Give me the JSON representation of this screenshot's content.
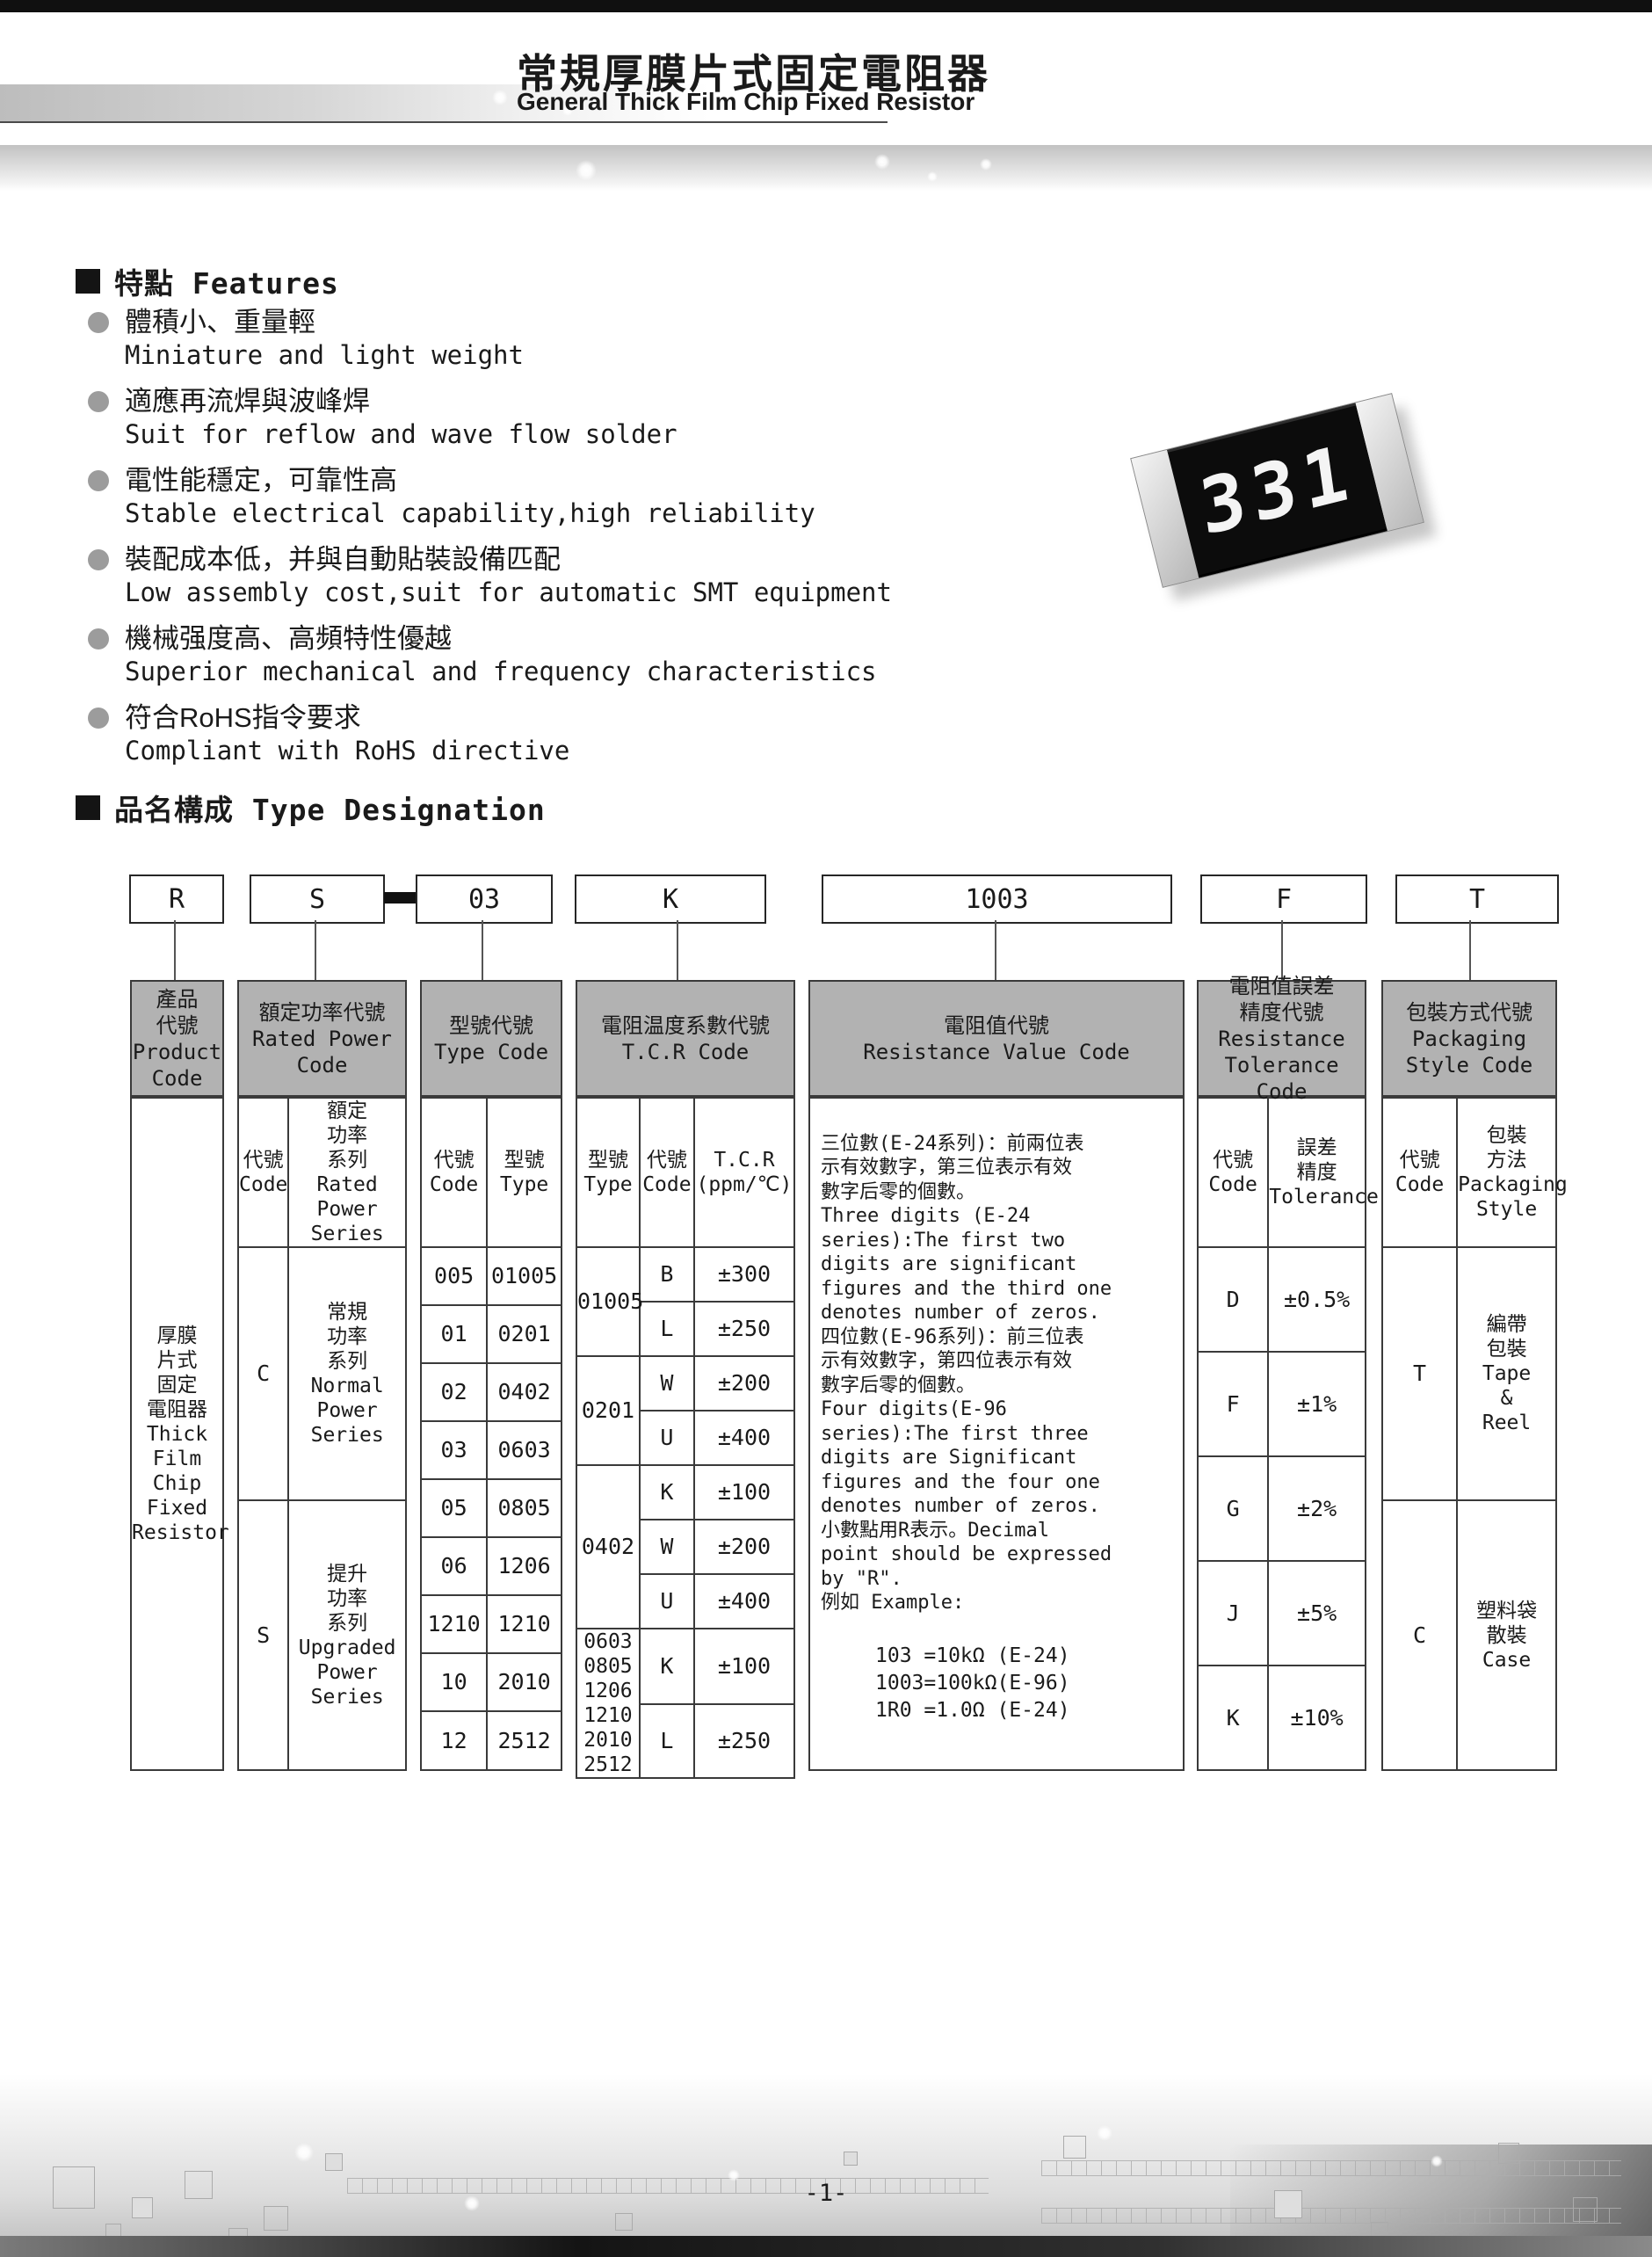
{
  "header": {
    "title_cn": "常規厚膜片式固定電阻器",
    "title_en": "General Thick Film Chip Fixed Resistor"
  },
  "features": {
    "heading": "特點 Features",
    "items": [
      {
        "cn": "體積小、重量輕",
        "en": "Miniature and light weight"
      },
      {
        "cn": "適應再流焊與波峰焊",
        "en": "Suit for reflow and wave flow solder"
      },
      {
        "cn": "電性能穩定，可靠性高",
        "en": "Stable electrical capability,high reliability"
      },
      {
        "cn": "裝配成本低，并與自動貼裝設備匹配",
        "en": "Low assembly cost,suit for automatic SMT equipment"
      },
      {
        "cn": "機械强度高、高頻特性優越",
        "en": "Superior mechanical and frequency characteristics"
      },
      {
        "cn": "符合RoHS指令要求",
        "en": "Compliant with RoHS directive"
      }
    ]
  },
  "chip": {
    "marking": "331"
  },
  "type_designation": {
    "heading": "品名構成  Type Designation",
    "boxes": [
      "R",
      "S",
      "03",
      "K",
      "1003",
      "F",
      "T"
    ],
    "separator_symbol": "-"
  },
  "table": {
    "product": {
      "header": [
        "產品",
        "代號",
        "Product",
        "Code"
      ],
      "body": [
        "厚膜",
        "片式",
        "固定",
        "電阻器",
        "Thick",
        "Film",
        "Chip",
        "Fixed",
        "Resistor"
      ]
    },
    "power": {
      "header": [
        "額定功率代號",
        "Rated Power",
        "Code"
      ],
      "sub_code": [
        "代號",
        "Code"
      ],
      "sub_series": [
        "額定",
        "功率",
        "系列",
        "Rated",
        "Power",
        "Series"
      ],
      "rows": [
        {
          "code": "C",
          "series": [
            "常規",
            "功率",
            "系列",
            "Normal",
            "Power",
            "Series"
          ]
        },
        {
          "code": "S",
          "series": [
            "提升",
            "功率",
            "系列",
            "Upgraded",
            "Power",
            "Series"
          ]
        }
      ]
    },
    "type": {
      "header": [
        "型號代號",
        "Type Code"
      ],
      "sub_code": [
        "代號",
        "Code"
      ],
      "sub_type": [
        "型號",
        "Type"
      ],
      "rows": [
        [
          "005",
          "01005"
        ],
        [
          "01",
          "0201"
        ],
        [
          "02",
          "0402"
        ],
        [
          "03",
          "0603"
        ],
        [
          "05",
          "0805"
        ],
        [
          "06",
          "1206"
        ],
        [
          "1210",
          "1210"
        ],
        [
          "10",
          "2010"
        ],
        [
          "12",
          "2512"
        ]
      ]
    },
    "tcr": {
      "header": [
        "電阻温度系數代號",
        "T.C.R Code"
      ],
      "sub_type": [
        "型號",
        "Type"
      ],
      "sub_code": [
        "代號",
        "Code"
      ],
      "sub_tcr": [
        "T.C.R",
        "(ppm/℃)"
      ],
      "groups": [
        {
          "type": "01005",
          "rows": [
            [
              "B",
              "±300"
            ],
            [
              "L",
              "±250"
            ]
          ]
        },
        {
          "type": "0201",
          "rows": [
            [
              "W",
              "±200"
            ],
            [
              "U",
              "±400"
            ]
          ]
        },
        {
          "type": "0402",
          "rows": [
            [
              "K",
              "±100"
            ],
            [
              "W",
              "±200"
            ],
            [
              "U",
              "±400"
            ]
          ]
        },
        {
          "type": [
            "0603",
            "0805",
            "1206",
            "1210",
            "2010",
            "2512"
          ],
          "rows": [
            [
              "K",
              "±100"
            ],
            [
              "L",
              "±250"
            ]
          ]
        }
      ]
    },
    "resistance": {
      "header": [
        "電阻值代號",
        "Resistance Value Code"
      ],
      "paragraph": [
        "三位數(E-24系列)：前兩位表",
        "示有效數字，第三位表示有效",
        "數字后零的個數。",
        "Three digits (E-24",
        "series):The first two",
        "digits are significant",
        "figures and the third one",
        "denotes number of zeros.",
        "四位數(E-96系列)：前三位表",
        "示有效數字，第四位表示有效",
        "數字后零的個數。",
        "Four digits(E-96",
        "series):The first three",
        "digits are Significant",
        "figures and the four one",
        "denotes number of zeros.",
        "小數點用R表示。Decimal",
        "point should be expressed",
        "by \"R\".",
        "例如 Example:"
      ],
      "examples": [
        "103 =10kΩ (E-24)",
        "1003=100kΩ(E-96)",
        "1R0 =1.0Ω (E-24)"
      ]
    },
    "tolerance": {
      "header": [
        "電阻值誤差",
        "精度代號",
        "Resistance",
        "Tolerance Code"
      ],
      "sub_code": [
        "代號",
        "Code"
      ],
      "sub_tol": [
        "誤差",
        "精度",
        "Tolerance"
      ],
      "rows": [
        [
          "D",
          "±0.5%"
        ],
        [
          "F",
          "±1%"
        ],
        [
          "G",
          "±2%"
        ],
        [
          "J",
          "±5%"
        ],
        [
          "K",
          "±10%"
        ]
      ]
    },
    "packaging": {
      "header": [
        "包裝方式代號",
        "Packaging",
        "Style Code"
      ],
      "sub_code": [
        "代號",
        "Code"
      ],
      "sub_style": [
        "包裝",
        "方法",
        "Packaging",
        "Style"
      ],
      "rows": [
        {
          "code": "T",
          "style": [
            "編帶",
            "包裝",
            "Tape",
            "&",
            "Reel"
          ]
        },
        {
          "code": "C",
          "style": [
            "塑料袋",
            "散裝",
            "Case"
          ]
        }
      ]
    }
  },
  "footer": {
    "page_number": "-1-"
  }
}
